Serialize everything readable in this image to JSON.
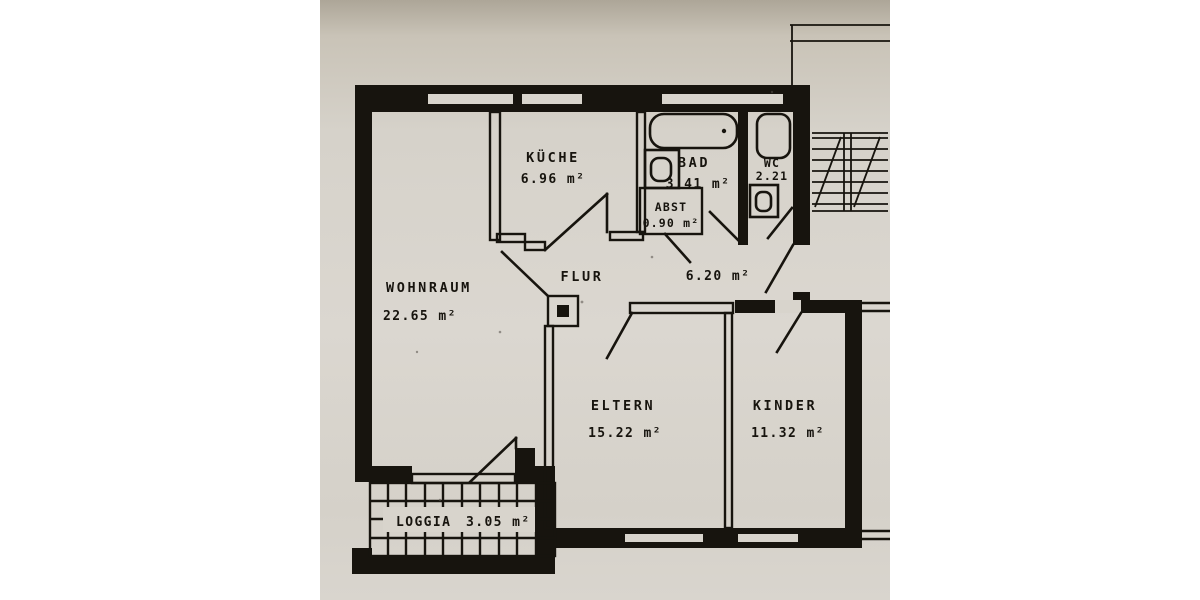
{
  "page": {
    "background_color": "#ffffff",
    "paper_color": "#d6d2ca",
    "ink_color": "#17140e"
  },
  "plan": {
    "type": "apartment-floor-plan",
    "rooms": [
      {
        "id": "wohnraum",
        "label": "WOHNRAUM",
        "area": "22.65 m²"
      },
      {
        "id": "kueche",
        "label": "KÜCHE",
        "area": "6.96 m²"
      },
      {
        "id": "bad",
        "label": "BAD",
        "area": "3.41 m²"
      },
      {
        "id": "wc",
        "label": "WC",
        "area": "2.21"
      },
      {
        "id": "abst",
        "label": "ABST",
        "area": "0.90 m²"
      },
      {
        "id": "flur",
        "label": "FLUR",
        "area": "6.20 m²"
      },
      {
        "id": "eltern",
        "label": "ELTERN",
        "area": "15.22 m²"
      },
      {
        "id": "kinder",
        "label": "KINDER",
        "area": "11.32 m²"
      },
      {
        "id": "loggia",
        "label": "LOGGIA",
        "area": "3.05 m²"
      }
    ],
    "fixtures": [
      "bathtub",
      "bath-sink",
      "toilet",
      "wc-sink",
      "shaft-box"
    ],
    "features": [
      "staircase",
      "loggia-tile-grid",
      "entrance-door",
      "window-openings"
    ]
  }
}
